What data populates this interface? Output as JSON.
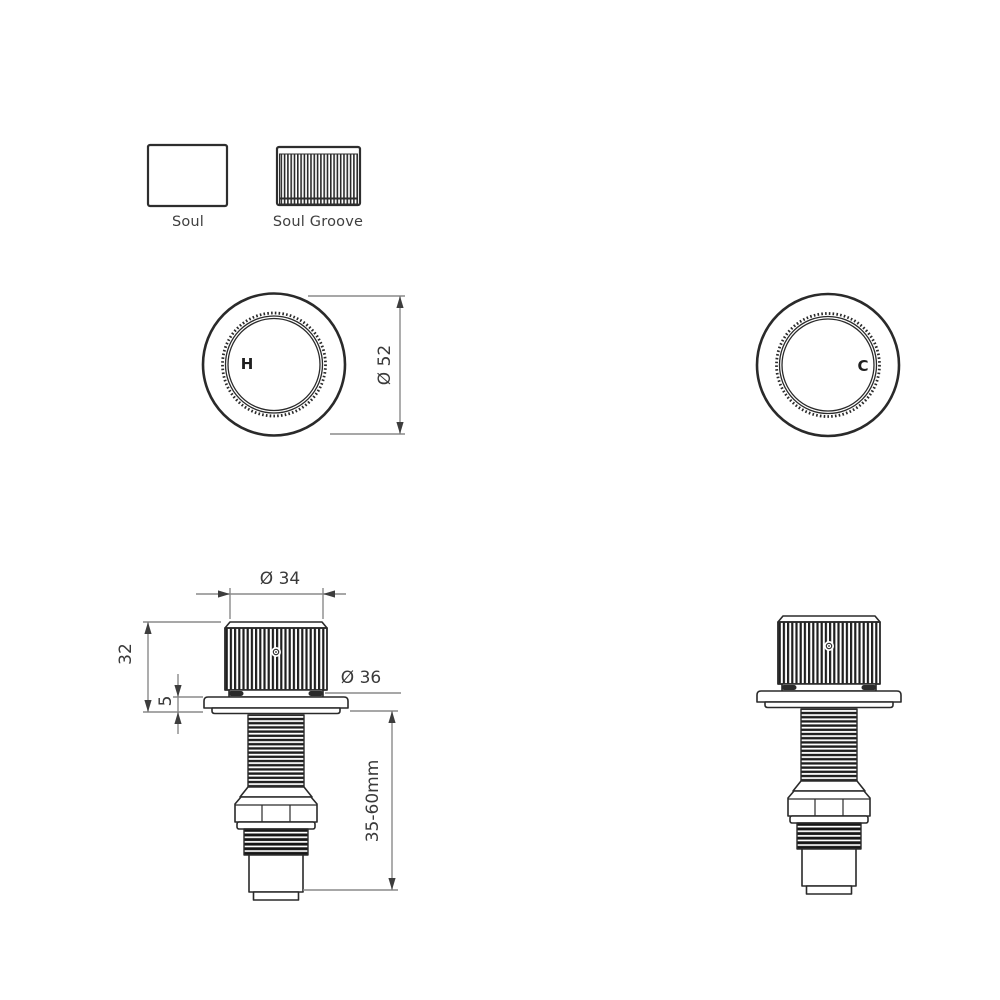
{
  "legend": {
    "soul": "Soul",
    "soul_groove": "Soul Groove"
  },
  "top_views": {
    "hot_label": "H",
    "cold_label": "C",
    "outer_diameter": "Ø 52"
  },
  "side_views": {
    "knob_diameter": "Ø 34",
    "knob_height": "32",
    "flange_thickness": "5",
    "base_diameter": "Ø 36",
    "thread_range": "35-60mm"
  },
  "colors": {
    "outline": "#2a2a2a",
    "dimension_line": "#8a8a8a",
    "arrow": "#3d3d3d",
    "text": "#3a3a3a",
    "background": "#ffffff"
  }
}
